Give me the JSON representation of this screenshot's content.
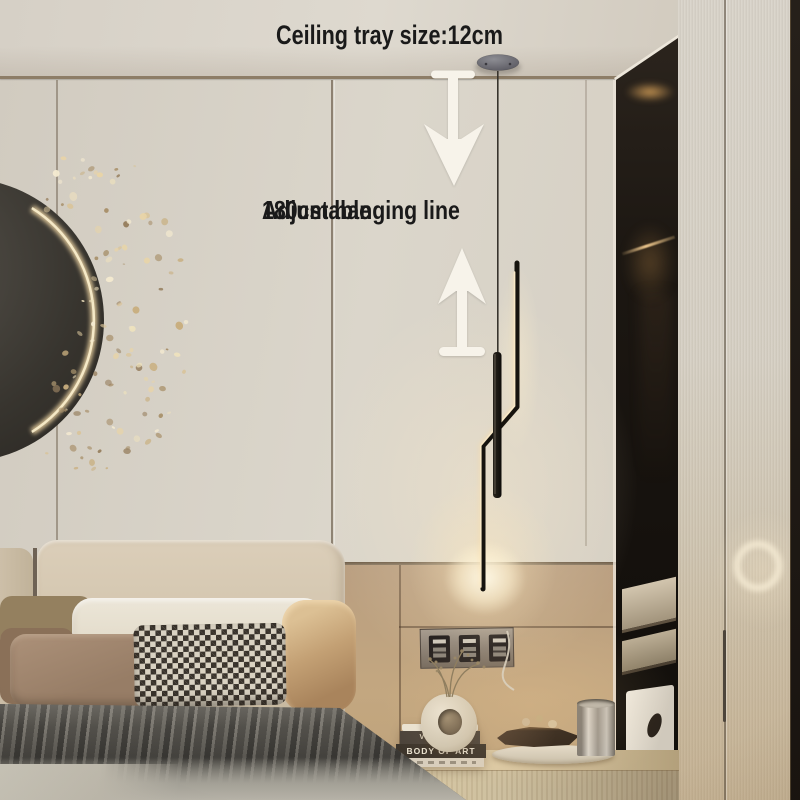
{
  "annotations": {
    "ceiling_tray": "Ceiling tray size:12cm",
    "hanging_line": "180cm hanging line",
    "adjustable": "Adjustable"
  },
  "nightstand": {
    "book_top_spine": "VENICE",
    "book_bottom_spine": "BODY OF ART"
  },
  "icons": {
    "down_arrow": "down-arrow",
    "up_arrow": "up-arrow"
  },
  "colors": {
    "annotation_text": "#1a1a1a",
    "arrow_white": "#f7f3ea",
    "lamp_glow": "#ffe8c0",
    "lamp_body": "#16130e",
    "wall_cream": "#d8d2c7",
    "wall_tan": "#b59a7c",
    "accent_gold": "#dcbf90"
  }
}
